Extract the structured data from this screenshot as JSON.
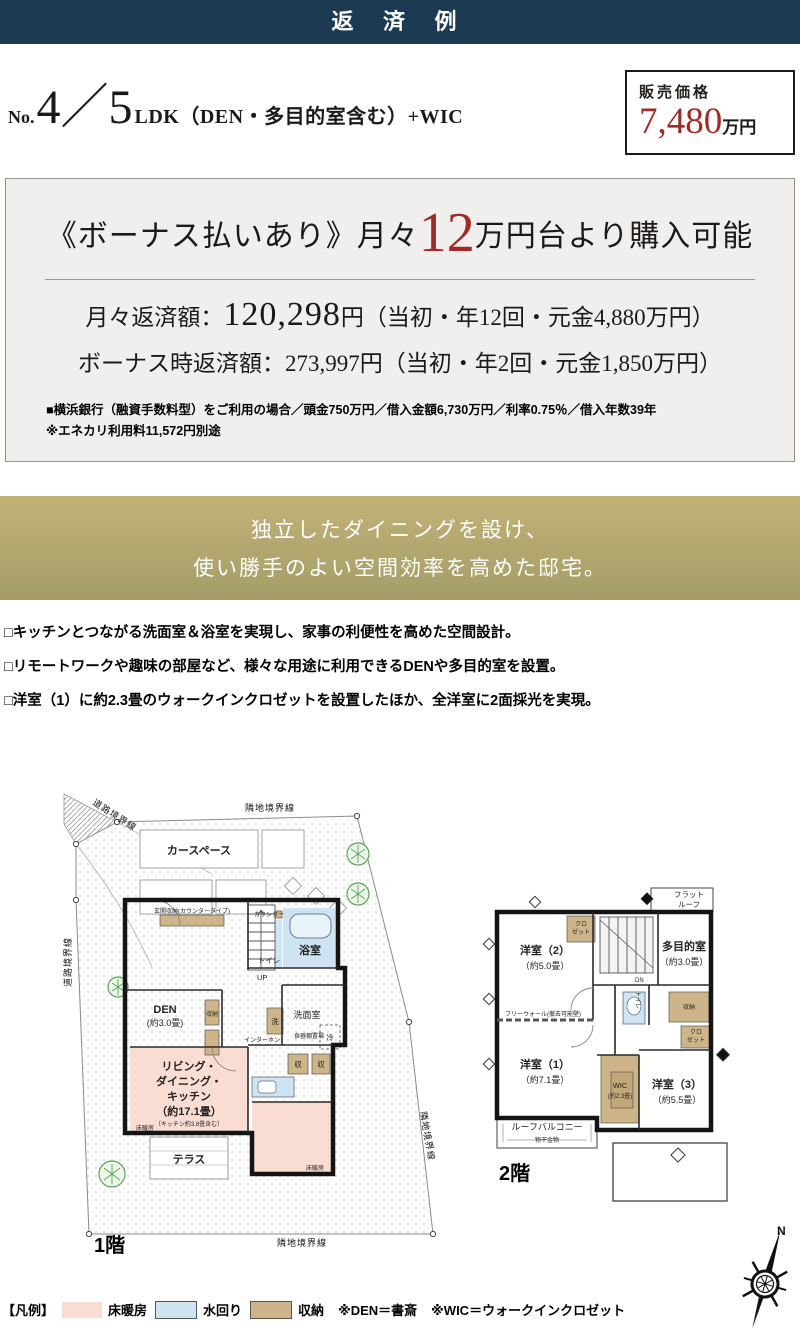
{
  "header": {
    "title": "返 済 例"
  },
  "listing": {
    "no_label": "No.",
    "number": "4／5",
    "type_suffix": "LDK（DEN・多目的室含む）+WIC"
  },
  "price_box": {
    "label": "販売価格",
    "amount": "7,480",
    "unit": "万円"
  },
  "repayment": {
    "headline_open": "《ボーナス払いあり》月々",
    "headline_number": "12",
    "headline_close": "万円台より購入可能",
    "monthly_label": "月々返済額：",
    "monthly_amount": "120,298",
    "monthly_detail": "円（当初・年12回・元金4,880万円）",
    "bonus_label": "ボーナス時返済額：",
    "bonus_amount": "273,997",
    "bonus_detail": "円（当初・年2回・元金1,850万円）",
    "bank_note": "■横浜銀行（融資手数料型）をご利用の場合／頭金750万円／借入金額6,730万円／利率0.75％／借入年数39年",
    "energy_note": "※エネカリ利用料11,572円別途"
  },
  "feature_banner": {
    "line1": "独立したダイニングを設け、",
    "line2": "使い勝手のよい空間効率を高めた邸宅。"
  },
  "features": [
    "□キッチンとつながる洗面室＆浴室を実現し、家事の利便性を高めた空間設計。",
    "□リモートワークや趣味の部屋など、様々な用途に利用できるDENや多目的室を設置。",
    "□洋室（1）に約2.3畳のウォークインクロゼットを設置したほか、全洋室に2面採光を実現。"
  ],
  "floorplan1": {
    "floor_label": "1階",
    "boundaries": {
      "top": "隣地境界線",
      "corner": "道路境界線",
      "left": "道路境界線",
      "right": "隣地境界線",
      "bottom": "隣地境界線"
    },
    "rooms": {
      "car_space": "カースペース",
      "entrance_storage": "玄関収納(カウンタータイプ)",
      "counter": "カウンター",
      "toilet": "トイレ",
      "bath": "浴室",
      "up": "UP",
      "den": "DEN",
      "den_size": "(約3.0畳)",
      "storage": "収納",
      "washer": "洗",
      "washroom": "洗面室",
      "dish_shelf": "食器棚置場",
      "fridge": "冷",
      "stor_s1": "収",
      "stor_s2": "収",
      "intercom": "インターホン",
      "ldk_line1": "リビング・",
      "ldk_line2": "ダイニング・",
      "ldk_line3": "キッチン",
      "ldk_size": "（約17.1畳）",
      "ldk_note": "（キッチン約3.8畳含む）",
      "floor_heating1": "床暖房",
      "floor_heating2": "床暖房",
      "terrace": "テラス"
    }
  },
  "floorplan2": {
    "floor_label": "2階",
    "rooms": {
      "flat_roof1": "フラット",
      "flat_roof2": "ルーフ",
      "closet_a1": "クロ",
      "closet_a2": "ゼット",
      "west2": "洋室（2）",
      "west2_size": "（約5.0畳）",
      "dn": "DN",
      "multi": "多目的室",
      "multi_size": "（約3.0畳）",
      "free_wall": "フリーウォール(撤去可能壁)",
      "toilet": "トイレ",
      "storage": "収納",
      "closet_b1": "クロ",
      "closet_b2": "ゼット",
      "west1": "洋室（1）",
      "west1_size": "（約7.1畳）",
      "wic": "WIC",
      "wic_size": "(約2.3畳)",
      "west3": "洋室（3）",
      "west3_size": "（約5.5畳）",
      "roof_balcony": "ルーフバルコニー",
      "laundry_hw": "物干金物"
    }
  },
  "compass": {
    "north": "N"
  },
  "legend": {
    "title": "【凡例】",
    "items": [
      {
        "label": "床暖房",
        "color": "#f9ddd3"
      },
      {
        "label": "水回り",
        "color": "#cfe4f2"
      },
      {
        "label": "収納",
        "color": "#cdb489"
      }
    ],
    "note_den": "※DEN＝書斎",
    "note_wic": "※WIC＝ウォークインクロゼット"
  },
  "colors": {
    "navy": "#1c3b52",
    "accent_red": "#9e2b26",
    "gold_top": "#c2b277",
    "gold_bottom": "#a49d68",
    "panel_bg": "#f1efed",
    "floor_heating_pink": "#f9ddd3",
    "water_blue": "#cfe4f2",
    "storage_tan": "#cdb489"
  }
}
